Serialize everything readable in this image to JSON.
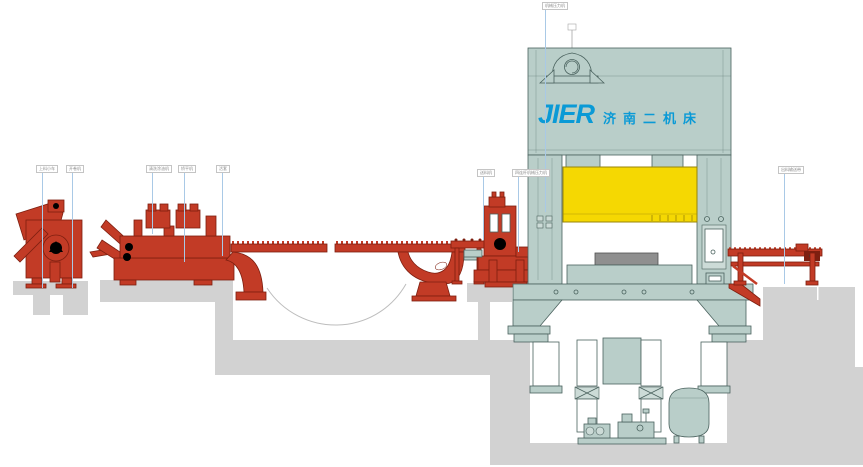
{
  "diagram": {
    "title": "press-line-side-elevation",
    "logo": {
      "brand": "JIER",
      "brand_cn": "济南二机床"
    },
    "colors": {
      "equipment_red": "#c23b26",
      "red_outline": "#7e1f10",
      "press_teal": "#b9cec9",
      "teal_outline": "#4a625e",
      "teal_light": "#ccdbd7",
      "die_yellow": "#f5d802",
      "yellow_outline": "#98850a",
      "concrete_gray": "#d2d2d2",
      "bolster_gray": "#8f8f8f",
      "leader_blue": "#a9c9e6",
      "logo_blue": "#0a9ad6",
      "label_text": "#8a8a8a",
      "label_border": "#c4c4c4",
      "loop_line": "#bdbdbd"
    },
    "callouts": [
      {
        "label": "上料小车",
        "x": 36,
        "y": 165,
        "leader_x": 42,
        "leader_y2": 288
      },
      {
        "label": "开卷机",
        "x": 66,
        "y": 165,
        "leader_x": 72,
        "leader_y2": 288
      },
      {
        "label": "清洗涂油机",
        "x": 146,
        "y": 165,
        "leader_x": 152,
        "leader_y2": 234
      },
      {
        "label": "矫平机",
        "x": 178,
        "y": 165,
        "leader_x": 184,
        "leader_y2": 262
      },
      {
        "label": "活套",
        "x": 216,
        "y": 165,
        "leader_x": 222,
        "leader_y2": 256
      },
      {
        "label": "送料机",
        "x": 477,
        "y": 169,
        "leader_x": 483,
        "leader_y2": 240
      },
      {
        "label": "四连杆机械压力机",
        "x": 512,
        "y": 169,
        "leader_x": 518,
        "leader_y2": 252
      },
      {
        "label": "机械压力机",
        "x": 542,
        "y": 2,
        "leader_x": 545,
        "leader_y2": 212
      },
      {
        "label": "出料输送带",
        "x": 778,
        "y": 166,
        "leader_x": 784,
        "leader_y2": 284
      }
    ]
  }
}
